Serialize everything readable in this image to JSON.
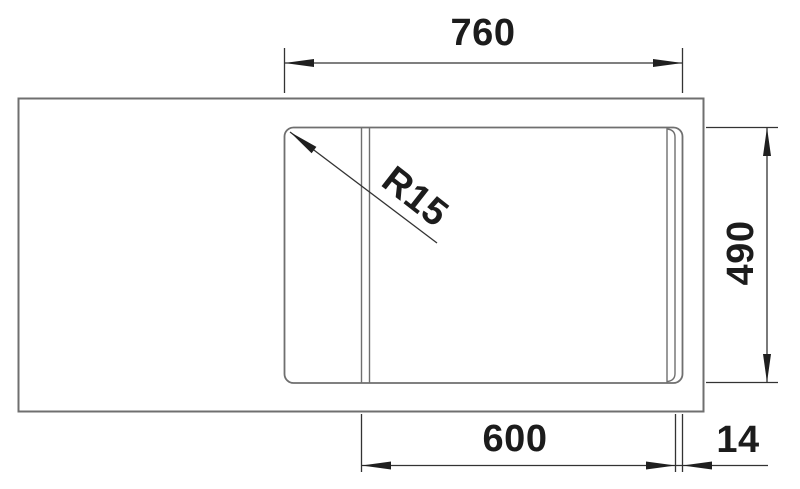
{
  "drawing": {
    "dimensions": {
      "top_width": "760",
      "right_height": "490",
      "bottom_inner_width": "600",
      "bottom_edge_offset": "14",
      "corner_radius": "R15"
    },
    "colors": {
      "background": "#ffffff",
      "outline_gray": "#6f6f6f",
      "dimension_line": "#333333",
      "arrow_fill": "#1f1f1f",
      "label_text": "#1c1c1c"
    }
  }
}
